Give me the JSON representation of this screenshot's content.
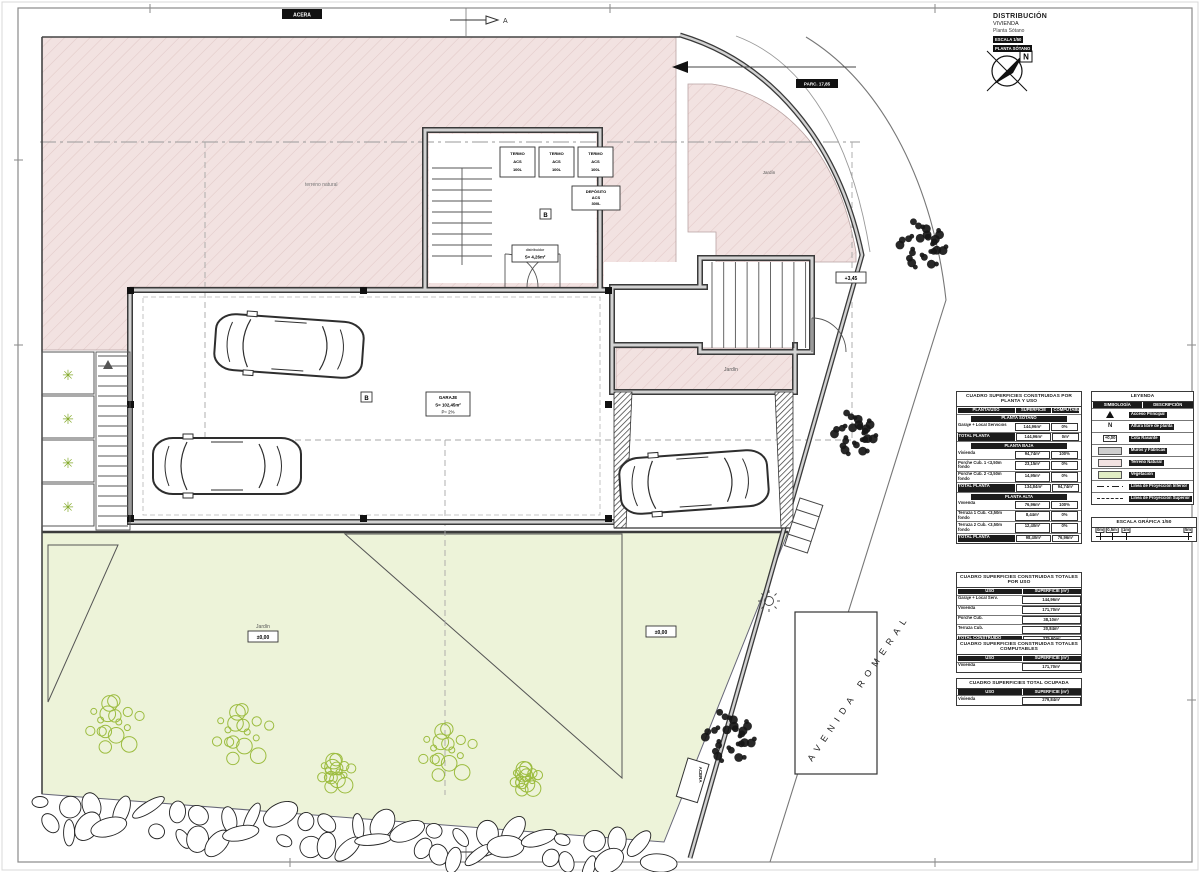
{
  "colors": {
    "terrain_pink": "#f2e2e1",
    "garden_green": "#edf3d9",
    "wall_gray": "#d2d2d2",
    "plant_green": "#9cbc3f",
    "tree_dark": "#161616"
  },
  "title_block": {
    "line1": "DISTRIBUCIÓN",
    "line2": "VIVIENDA",
    "line3": "Planta Sótano",
    "bar1": "ESCALA 1/50",
    "bar2": "PLANTA SÓTANO"
  },
  "north": {
    "label": "N"
  },
  "section_markers": {
    "top": "A",
    "bottom": "A"
  },
  "street": {
    "name": "AVENIDA ROMERAL",
    "sidewalk_top": "ACERA",
    "sidewalk_bottom": "ACERA",
    "parcel_label": "PARC. 17,85"
  },
  "plan_labels": {
    "terreno_natural": "terreno natural",
    "jardin_top_right": "Jardín",
    "jardin_strip": "Jardín",
    "jardin_left": "Jardín",
    "jardin_left_level": "±0,00",
    "jardin_right_level": "±0,00",
    "stair_level": "+3,45",
    "distribuidor": "distribuidor",
    "distribuidor_area": "S= 4,26m²",
    "garage_title": "GARAJE",
    "garage_area": "S= 102,45m²",
    "garage_note": "P= 2%",
    "marker_b1": "B",
    "marker_b2": "B",
    "equipment": [
      {
        "l1": "TERMO",
        "l2": "ACS",
        "l3": "100L"
      },
      {
        "l1": "TERMO",
        "l2": "ACS",
        "l3": "100L"
      },
      {
        "l1": "TERMO",
        "l2": "ACS",
        "l3": "100L"
      }
    ],
    "deposit": {
      "l1": "DEPÓSITO",
      "l2": "ACS",
      "l3": "300L"
    }
  },
  "tables": [
    {
      "title": "CUADRO SUPERFICIES CONSTRUIDAS POR PLANTA Y USO",
      "headers": [
        "PLANTA/USO",
        "SUPERFICIE",
        "COMPUTABLE"
      ],
      "rows": [
        {
          "type": "section",
          "label": "PLANTA SÓTANO"
        },
        {
          "type": "data",
          "cells": [
            "Garaje + Local Servicios",
            "144,96m²",
            "0%"
          ]
        },
        {
          "type": "total",
          "cells": [
            "TOTAL PLANTA",
            "144,96m²",
            "0m²"
          ]
        },
        {
          "type": "section",
          "label": "PLANTA BAJA"
        },
        {
          "type": "data",
          "cells": [
            "Vivienda",
            "94,74m²",
            "100%"
          ]
        },
        {
          "type": "data",
          "cells": [
            "Porche Cub. 1 <3,50m fondo",
            "23,15m²",
            "0%"
          ]
        },
        {
          "type": "data",
          "cells": [
            "Porche Cub. 2 <3,50m fondo",
            "14,95m²",
            "0%"
          ]
        },
        {
          "type": "total",
          "cells": [
            "TOTAL PLANTA",
            "134,84m²",
            "94,74m²"
          ]
        },
        {
          "type": "section",
          "label": "PLANTA ALTA"
        },
        {
          "type": "data",
          "cells": [
            "Vivienda",
            "76,96m²",
            "100%"
          ]
        },
        {
          "type": "data",
          "cells": [
            "Terraza 1 Cub. <3,50m fondo",
            "8,44m²",
            "0%"
          ]
        },
        {
          "type": "data",
          "cells": [
            "Terraza 2 Cub. <3,50m fondo",
            "12,40m²",
            "0%"
          ]
        },
        {
          "type": "total",
          "cells": [
            "TOTAL PLANTA",
            "98,40m²",
            "76,96m²"
          ]
        }
      ]
    },
    {
      "title": "CUADRO SUPERFICIES CONSTRUIDAS TOTALES POR USO",
      "headers": [
        "USO",
        "SUPERFICIE (m²)"
      ],
      "rows": [
        {
          "type": "data",
          "cells": [
            "Garaje + Local Serv.",
            "144,96m²"
          ]
        },
        {
          "type": "data",
          "cells": [
            "Vivienda",
            "171,70m²"
          ]
        },
        {
          "type": "data",
          "cells": [
            "Porche Cub.",
            "38,10m²"
          ]
        },
        {
          "type": "data",
          "cells": [
            "Terraza Cub.",
            "20,84m²"
          ]
        },
        {
          "type": "total",
          "cells": [
            "TOTAL CONSTRUIDO",
            "375,60m²"
          ]
        }
      ]
    },
    {
      "title": "CUADRO SUPERFICIES CONSTRUIDAS TOTALES COMPUTABLES",
      "headers": [
        "USO",
        "SUPERFICIE (m²)"
      ],
      "rows": [
        {
          "type": "data",
          "cells": [
            "Vivienda",
            "171,70m²"
          ]
        }
      ]
    },
    {
      "title": "CUADRO SUPERFICIES TOTAL OCUPADA",
      "headers": [
        "USO",
        "SUPERFICIE (m²)"
      ],
      "rows": [
        {
          "type": "data",
          "cells": [
            "Vivienda",
            "279,84m²"
          ]
        }
      ]
    }
  ],
  "legend": {
    "title": "LEYENDA",
    "headers": [
      "SIMBOLOGÍA",
      "DESCRIPCIÓN"
    ],
    "rows": [
      {
        "symbol": "triangle",
        "label": "",
        "desc": "Acceso Principal"
      },
      {
        "symbol": "letter",
        "label": "N",
        "desc": "Altura libre de planta"
      },
      {
        "symbol": "cota",
        "label": "+0,00",
        "desc": "Cota Rasante"
      },
      {
        "symbol": "swatch-gray",
        "label": "",
        "desc": "Muros y Fábricas"
      },
      {
        "symbol": "swatch-pink",
        "label": "",
        "desc": "Terreno Natural"
      },
      {
        "symbol": "swatch-green",
        "label": "",
        "desc": "Vegetación"
      },
      {
        "symbol": "dashdot",
        "label": "",
        "desc": "Línea de Proyección Inferior"
      },
      {
        "symbol": "dash",
        "label": "",
        "desc": "Línea de Proyección Superior"
      }
    ]
  },
  "scale": {
    "title": "ESCALA GRÁFICA 1/50",
    "ticks": [
      "0m",
      "0,5m",
      "1m",
      "5m"
    ],
    "tick_pos": [
      4,
      16,
      30,
      92
    ]
  }
}
